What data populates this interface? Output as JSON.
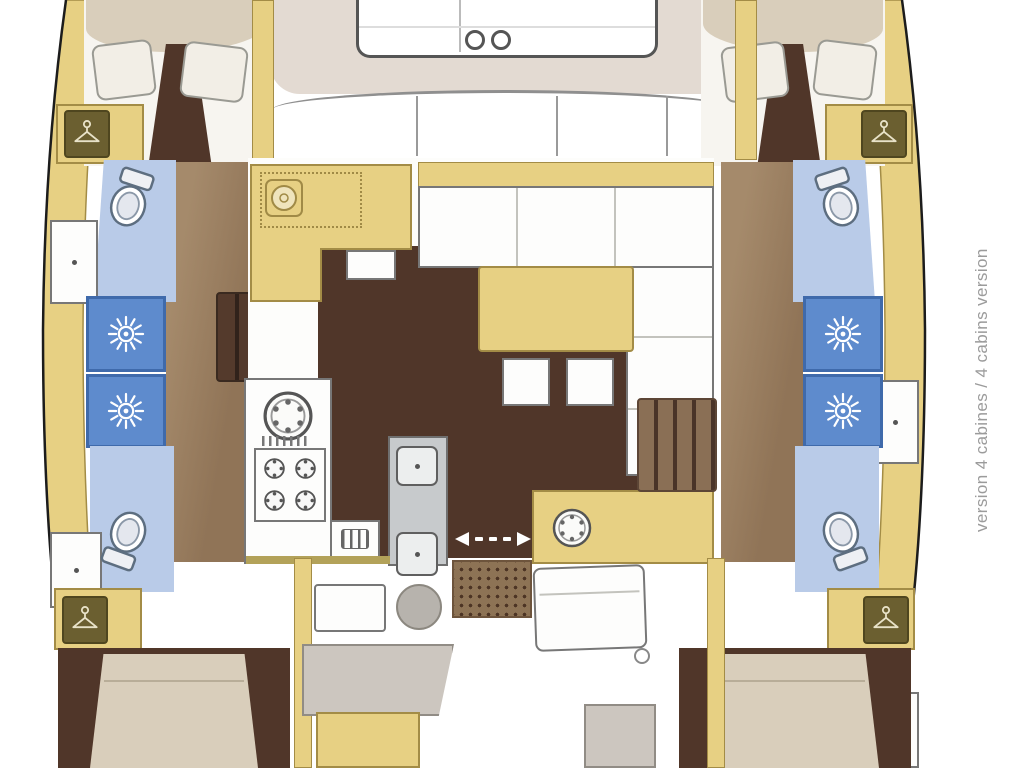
{
  "annotation": {
    "label": "version 4 cabines / 4 cabins version"
  },
  "plan": {
    "type": "catamaran-floor-plan",
    "orientation": "bow-up",
    "cabins": 4,
    "heads": 4,
    "showers": 4
  },
  "palette": {
    "hull_wood": "#e7d083",
    "wood_border": "#a38c46",
    "wood_icon_box": "#6b5f30",
    "floor_dark": "#503629",
    "floor_mid": "#907457",
    "floor_mid_light": "#a58a6b",
    "head_floor_blue": "#b9cbe8",
    "shower_blue": "#5e8bcd",
    "shower_border": "#3f6aab",
    "bed_beige": "#d9cebb",
    "pillow_white": "#f2eee6",
    "coachroof_beige": "#e3dad2",
    "deck_white": "#fdfdfb",
    "counter_gray": "#c7cacc",
    "seat_gray": "#ccc6bf",
    "mat_brown": "#8d7355",
    "outline_dark": "#1c1c1c",
    "line_gray": "#777777",
    "annotation_gray": "#9b9b9b"
  },
  "icons": {
    "shower": "sun-icon",
    "toilet": "toilet-icon",
    "wardrobe": "hanging-locker-icon",
    "round_sink": "round-sink-icon",
    "stove_burner": "burner-icon",
    "double_sink": "double-sink-icon",
    "chart_instrument": "chart-instrument-icon",
    "sliding_door": "double-arrow-icon",
    "cup_holders": "cup-holder-icon",
    "icebox": "icebox-icon",
    "doormat": "doormat-grid",
    "cockpit_table_round": "round-table-icon"
  }
}
